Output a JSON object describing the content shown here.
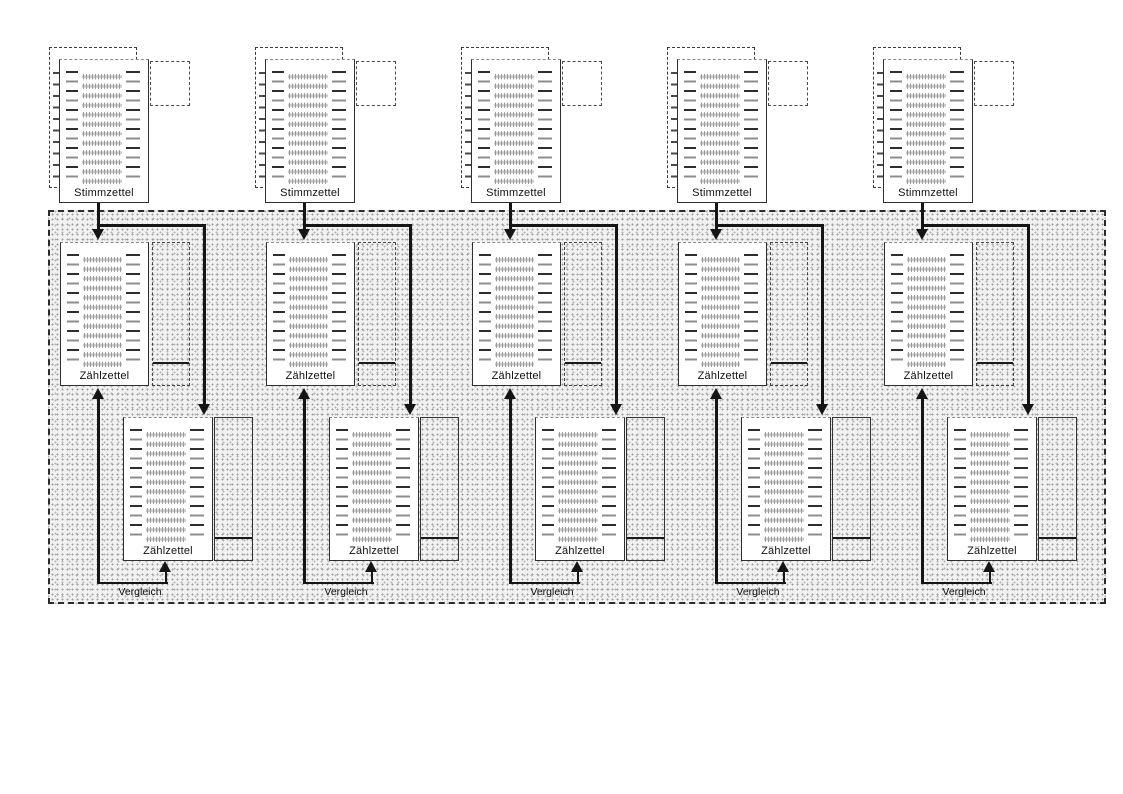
{
  "diagram": {
    "columns": [
      {
        "stimmzettel_label": "Stimmzettel",
        "zaehlzettel_top_label": "Zählzettel",
        "zaehlzettel_bottom_label": "Zählzettel",
        "vergleich_label": "Vergleich"
      },
      {
        "stimmzettel_label": "Stimmzettel",
        "zaehlzettel_top_label": "Zählzettel",
        "zaehlzettel_bottom_label": "Zählzettel",
        "vergleich_label": "Vergleich"
      },
      {
        "stimmzettel_label": "Stimmzettel",
        "zaehlzettel_top_label": "Zählzettel",
        "zaehlzettel_bottom_label": "Zählzettel",
        "vergleich_label": "Vergleich"
      },
      {
        "stimmzettel_label": "Stimmzettel",
        "zaehlzettel_top_label": "Zählzettel",
        "zaehlzettel_bottom_label": "Zählzettel",
        "vergleich_label": "Vergleich"
      },
      {
        "stimmzettel_label": "Stimmzettel",
        "zaehlzettel_top_label": "Zählzettel",
        "zaehlzettel_bottom_label": "Zählzettel",
        "vergleich_label": "Vergleich"
      }
    ],
    "colors": {
      "background": "#ffffff",
      "paper": "#ffffff",
      "line": "#151515",
      "region_background": "#f1f1f1",
      "region_dot": "#9d9d9d",
      "border": "#2e2e2e"
    }
  }
}
